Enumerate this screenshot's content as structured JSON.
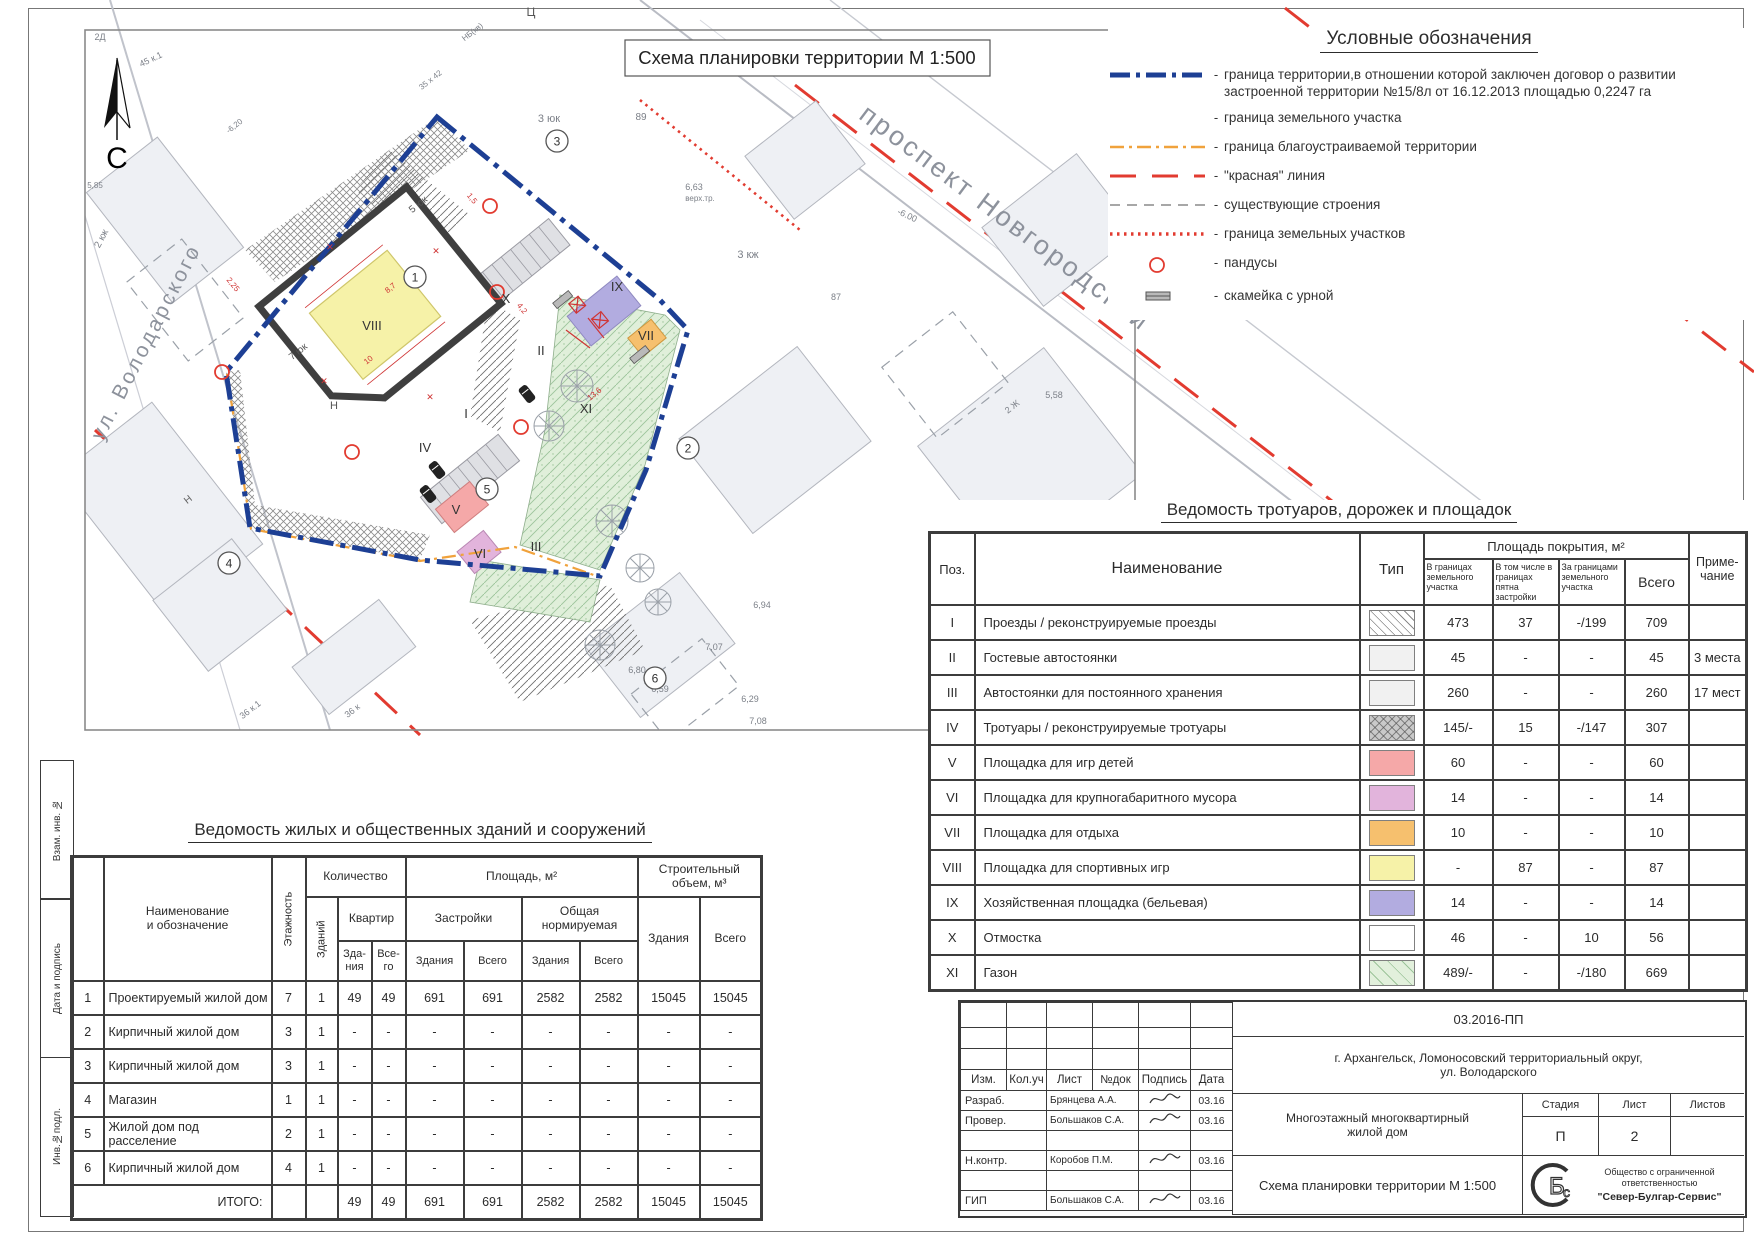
{
  "colors": {
    "boundary_blue": "#1d3f94",
    "orange": "#f0a23c",
    "red": "#e23b30",
    "gray": "#8a8a8a",
    "line_dark": "#3a3a3a"
  },
  "map": {
    "title": "Схема планировки территории М 1:500",
    "north_label": "С",
    "streets": [
      {
        "t": "проспект Новгородский",
        "x": 1000,
        "y": 225,
        "r": 37,
        "s": 27
      },
      {
        "t": "ул. Володарского",
        "x": 152,
        "y": 345,
        "r": -63,
        "s": 21
      }
    ],
    "roman_labels": [
      {
        "t": "VIII",
        "x": 372,
        "y": 330
      },
      {
        "t": "IX",
        "x": 617,
        "y": 291
      },
      {
        "t": "VII",
        "x": 646,
        "y": 340
      },
      {
        "t": "II",
        "x": 541,
        "y": 355
      },
      {
        "t": "XI",
        "x": 586,
        "y": 413
      },
      {
        "t": "I",
        "x": 466,
        "y": 418
      },
      {
        "t": "IV",
        "x": 425,
        "y": 452
      },
      {
        "t": "V",
        "x": 456,
        "y": 514
      },
      {
        "t": "VI",
        "x": 480,
        "y": 558
      },
      {
        "t": "III",
        "x": 536,
        "y": 551
      },
      {
        "t": "X",
        "x": 506,
        "y": 303
      }
    ],
    "circled_numbers": [
      {
        "n": "1",
        "x": 415,
        "y": 277
      },
      {
        "n": "2",
        "x": 688,
        "y": 448
      },
      {
        "n": "3",
        "x": 557,
        "y": 141
      },
      {
        "n": "4",
        "x": 229,
        "y": 563
      },
      {
        "n": "5",
        "x": 487,
        "y": 489
      },
      {
        "n": "6",
        "x": 655,
        "y": 678
      }
    ],
    "annotations": [
      {
        "t": "Ц",
        "x": 531,
        "y": 16,
        "s": 12,
        "c": "#555"
      },
      {
        "t": "3 юк",
        "x": 549,
        "y": 122,
        "s": 11
      },
      {
        "t": "89",
        "x": 641,
        "y": 120,
        "s": 10
      },
      {
        "t": "3 кж",
        "x": 748,
        "y": 258,
        "s": 11
      },
      {
        "t": "2 кж",
        "x": 104,
        "y": 240,
        "s": 10,
        "r": -62
      },
      {
        "t": "45 к.1",
        "x": 152,
        "y": 62,
        "s": 9,
        "r": -25
      },
      {
        "t": "2Д",
        "x": 100,
        "y": 40,
        "s": 9
      },
      {
        "t": "35 х 42",
        "x": 432,
        "y": 82,
        "s": 8,
        "r": -38
      },
      {
        "t": "НБ(кв)",
        "x": 474,
        "y": 34,
        "s": 8,
        "r": -38
      },
      {
        "t": "-6,20",
        "x": 236,
        "y": 128,
        "s": 8,
        "r": -38
      },
      {
        "t": "5,85",
        "x": 95,
        "y": 188,
        "s": 8
      },
      {
        "t": "6,63",
        "x": 694,
        "y": 190,
        "s": 9
      },
      {
        "t": "верх.тр.",
        "x": 700,
        "y": 201,
        "s": 8
      },
      {
        "t": "-6.00",
        "x": 906,
        "y": 218,
        "s": 9,
        "r": 25
      },
      {
        "t": "87",
        "x": 836,
        "y": 300,
        "s": 9
      },
      {
        "t": "5,58",
        "x": 1054,
        "y": 398,
        "s": 9
      },
      {
        "t": "2 Ж",
        "x": 1014,
        "y": 409,
        "s": 9,
        "r": -38
      },
      {
        "t": "6,94",
        "x": 762,
        "y": 608,
        "s": 9
      },
      {
        "t": "6,98",
        "x": 992,
        "y": 588,
        "s": 9
      },
      {
        "t": "7,07",
        "x": 714,
        "y": 650,
        "s": 9
      },
      {
        "t": "6,80",
        "x": 637,
        "y": 673,
        "s": 9
      },
      {
        "t": "6,59",
        "x": 660,
        "y": 692,
        "s": 9
      },
      {
        "t": "6,29",
        "x": 750,
        "y": 702,
        "s": 9
      },
      {
        "t": "7,08",
        "x": 758,
        "y": 724,
        "s": 9
      },
      {
        "t": "36 к.1",
        "x": 252,
        "y": 712,
        "s": 9,
        "r": -38
      },
      {
        "t": "36 к",
        "x": 354,
        "y": 713,
        "s": 9,
        "r": -38
      },
      {
        "t": "Н",
        "x": 334,
        "y": 409,
        "s": 11,
        "c": "#555"
      },
      {
        "t": "Н",
        "x": 190,
        "y": 502,
        "s": 10,
        "r": -38,
        "c": "#666"
      },
      {
        "t": "5 юк",
        "x": 420,
        "y": 207,
        "s": 10,
        "r": -39,
        "c": "#555"
      },
      {
        "t": "7 юк",
        "x": 300,
        "y": 354,
        "s": 10,
        "r": -39,
        "c": "#555"
      },
      {
        "t": "8,7",
        "x": 392,
        "y": 290,
        "s": 8,
        "c": "#cf3434",
        "r": -39
      },
      {
        "t": "10",
        "x": 370,
        "y": 362,
        "s": 8,
        "c": "#cf3434",
        "r": -39
      },
      {
        "t": "2,25",
        "x": 231,
        "y": 286,
        "s": 8,
        "c": "#cf3434",
        "r": 51
      },
      {
        "t": "1,5",
        "x": 470,
        "y": 200,
        "s": 8,
        "c": "#cf3434",
        "r": 51
      },
      {
        "t": "13,6",
        "x": 596,
        "y": 396,
        "s": 8,
        "c": "#cf3434",
        "r": -39
      },
      {
        "t": "4,2",
        "x": 520,
        "y": 310,
        "s": 8,
        "c": "#cf3434",
        "r": 51
      },
      {
        "t": "✕",
        "x": 330,
        "y": 250,
        "s": 9,
        "c": "#cf3434"
      },
      {
        "t": "✕",
        "x": 436,
        "y": 254,
        "s": 9,
        "c": "#cf3434"
      },
      {
        "t": "✕",
        "x": 324,
        "y": 384,
        "s": 9,
        "c": "#cf3434"
      },
      {
        "t": "✕",
        "x": 430,
        "y": 400,
        "s": 9,
        "c": "#cf3434"
      }
    ]
  },
  "legend": {
    "title": "Условные обозначения",
    "dash": "-",
    "items": [
      {
        "symbol": "blue-dashdot",
        "label": "граница территории,в отношении которой заключен договор о развитии застроенной территории №15/8л от 16.12.2013 площадью 0,2247 га"
      },
      {
        "symbol": "none",
        "label": "граница земельного участка"
      },
      {
        "symbol": "orange-dashdot",
        "label": "граница благоустраиваемой территории"
      },
      {
        "symbol": "red-dash",
        "label": "\"красная\" линия"
      },
      {
        "symbol": "gray-dash",
        "label": "существующие строения"
      },
      {
        "symbol": "red-dot",
        "label": "граница земельных участков"
      },
      {
        "symbol": "red-circle",
        "label": "пандусы"
      },
      {
        "symbol": "bench",
        "label": "скамейка с урной"
      }
    ]
  },
  "walkways": {
    "title": "Ведомость тротуаров, дорожек и площадок",
    "col_pos": "Поз.",
    "col_name": "Наименование",
    "col_type": "Тип",
    "grp_area": "Площадь покрытия, м²",
    "col_a1": "В границах земельного участка",
    "col_a2": "В том числе в границах пятна застройки",
    "col_a3": "За границами земельного участка",
    "col_total": "Всего",
    "col_note": "Приме- чание",
    "rows": [
      {
        "pos": "I",
        "name": "Проезды / реконструируемые проезды",
        "type": "diag",
        "a1": "473",
        "a2": "37",
        "a3": "-/199",
        "total": "709",
        "note": ""
      },
      {
        "pos": "II",
        "name": "Гостевые автостоянки",
        "type": "plain",
        "a1": "45",
        "a2": "-",
        "a3": "-",
        "total": "45",
        "note": "3 места"
      },
      {
        "pos": "III",
        "name": "Автостоянки для постоянного хранения",
        "type": "plain",
        "a1": "260",
        "a2": "-",
        "a3": "-",
        "total": "260",
        "note": "17 мест"
      },
      {
        "pos": "IV",
        "name": "Тротуары / реконструируемые тротуары",
        "type": "graycross",
        "a1": "145/-",
        "a2": "15",
        "a3": "-/147",
        "total": "307",
        "note": ""
      },
      {
        "pos": "V",
        "name": "Площадка для игр детей",
        "type": "color",
        "color": "#f5a8a8",
        "a1": "60",
        "a2": "-",
        "a3": "-",
        "total": "60",
        "note": ""
      },
      {
        "pos": "VI",
        "name": "Площадка для крупногабаритного мусора",
        "type": "color",
        "color": "#e2b4dc",
        "a1": "14",
        "a2": "-",
        "a3": "-",
        "total": "14",
        "note": ""
      },
      {
        "pos": "VII",
        "name": "Площадка для отдыха",
        "type": "color",
        "color": "#f6c06e",
        "a1": "10",
        "a2": "-",
        "a3": "-",
        "total": "10",
        "note": ""
      },
      {
        "pos": "VIII",
        "name": "Площадка для спортивных игр",
        "type": "color",
        "color": "#f6f2a8",
        "a1": "-",
        "a2": "87",
        "a3": "-",
        "total": "87",
        "note": ""
      },
      {
        "pos": "IX",
        "name": "Хозяйственная площадка (бельевая)",
        "type": "color",
        "color": "#b2ace0",
        "a1": "14",
        "a2": "-",
        "a3": "-",
        "total": "14",
        "note": ""
      },
      {
        "pos": "X",
        "name": "Отмостка",
        "type": "white",
        "a1": "46",
        "a2": "-",
        "a3": "10",
        "total": "56",
        "note": ""
      },
      {
        "pos": "XI",
        "name": "Газон",
        "type": "green",
        "a1": "489/-",
        "a2": "-",
        "a3": "-/180",
        "total": "669",
        "note": ""
      }
    ]
  },
  "buildings": {
    "title": "Ведомость жилых и общественных зданий и сооружений",
    "col_num": "",
    "col_name": "Наименование\nи обозначение",
    "col_floors": "Этажность",
    "grp_qty": "Количество",
    "col_bld": "Зданий",
    "grp_flats": "Квартир",
    "col_flat_b": "Зда-\nния",
    "col_flat_t": "Все-\nго",
    "grp_area": "Площадь, м²",
    "grp_footprint": "Застройки",
    "grp_norm": "Общая\nнормируемая",
    "col_fz": "Здания",
    "col_fv": "Всего",
    "col_nz": "Здания",
    "col_nv": "Всего",
    "grp_vol": "Строительный\nобъем, м³",
    "vol_b": "Здания",
    "vol_t": "Всего",
    "total_label": "ИТОГО:",
    "rows": [
      {
        "num": "1",
        "name": "Проектируемый жилой дом",
        "vals": [
          "7",
          "1",
          "49",
          "49",
          "691",
          "691",
          "2582",
          "2582",
          "15045",
          "15045"
        ]
      },
      {
        "num": "2",
        "name": "Кирпичный жилой дом",
        "vals": [
          "3",
          "1",
          "-",
          "-",
          "-",
          "-",
          "-",
          "-",
          "-",
          "-"
        ]
      },
      {
        "num": "3",
        "name": "Кирпичный жилой дом",
        "vals": [
          "3",
          "1",
          "-",
          "-",
          "-",
          "-",
          "-",
          "-",
          "-",
          "-"
        ]
      },
      {
        "num": "4",
        "name": "Магазин",
        "vals": [
          "1",
          "1",
          "-",
          "-",
          "-",
          "-",
          "-",
          "-",
          "-",
          "-"
        ]
      },
      {
        "num": "5",
        "name": "Жилой дом под расселение",
        "vals": [
          "2",
          "1",
          "-",
          "-",
          "-",
          "-",
          "-",
          "-",
          "-",
          "-"
        ]
      },
      {
        "num": "6",
        "name": "Кирпичный жилой дом",
        "vals": [
          "4",
          "1",
          "-",
          "-",
          "-",
          "-",
          "-",
          "-",
          "-",
          "-"
        ]
      }
    ],
    "totals": [
      "",
      "",
      "49",
      "49",
      "691",
      "691",
      "2582",
      "2582",
      "15045",
      "15045"
    ]
  },
  "stamp": {
    "doc_number": "03.2016-ПП",
    "location": "г. Архангельск, Ломоносовский территориальный округ,\nул. Володарского",
    "object": "Многоэтажный многоквартирный\nжилой дом",
    "sheet_title": "Схема планировки территории М 1:500",
    "stage_label": "Стадия",
    "sheet_label": "Лист",
    "sheets_label": "Листов",
    "stage": "П",
    "sheet": "2",
    "sheets": "",
    "header_cells": [
      "Изм.",
      "Кол.уч",
      "Лист",
      "№док",
      "Подпись",
      "Дата"
    ],
    "rows": [
      {
        "role": "Разраб.",
        "name": "Брянцева А.А.",
        "sig": true,
        "date": "03.16"
      },
      {
        "role": "Провер.",
        "name": "Большаков С.А.",
        "sig": true,
        "date": "03.16"
      },
      {
        "role": "",
        "name": "",
        "sig": false,
        "date": ""
      },
      {
        "role": "Н.контр.",
        "name": "Коробов П.М.",
        "sig": true,
        "date": "03.16"
      },
      {
        "role": "",
        "name": "",
        "sig": false,
        "date": ""
      },
      {
        "role": "ГИП",
        "name": "Большаков С.А.",
        "sig": true,
        "date": "03.16"
      }
    ],
    "logo": "СБс",
    "company_small": "Общество с ограниченной ответственностью",
    "company_name": "\"Север-Булгар-Сервис\""
  },
  "side_strip": {
    "labels": [
      "Взам. инв. №",
      "Дата и подпись",
      "Инв.№подл."
    ]
  }
}
